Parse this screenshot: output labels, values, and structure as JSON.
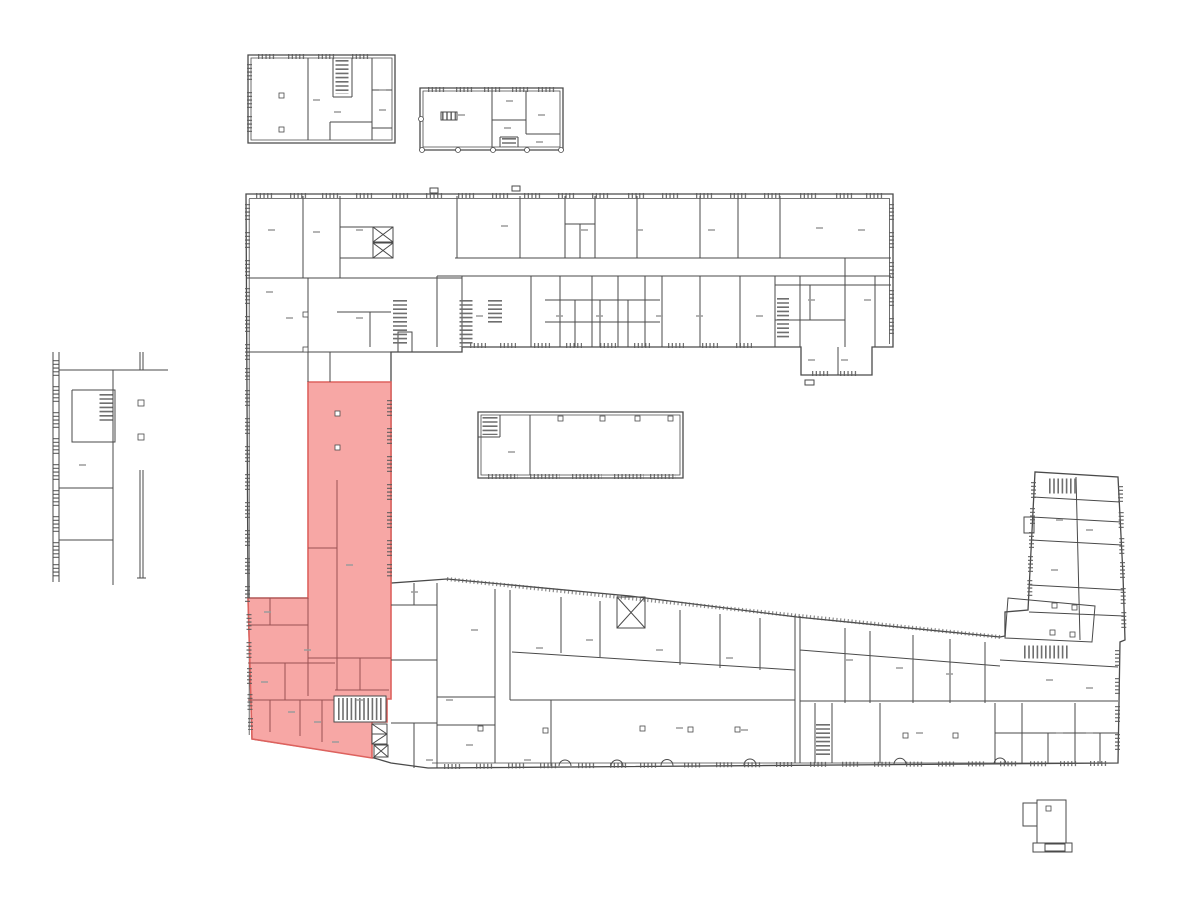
{
  "colors": {
    "bg": "#ffffff",
    "walls": "#4a4a4a",
    "windows": "#5a5a5a",
    "stairs": "#6f6f6f",
    "labels": "#9b9b9b",
    "hl-fill": "#f7a7a5",
    "hl-border": "#dd625e",
    "hl-walls": "#9a5252"
  },
  "highlight": {
    "points": "308,382 391,382 391,699 387,699 387,722 372,722 372,758 252,739 248,598 308,598",
    "stair_cutout": {
      "x": 334,
      "y": 696,
      "w": 52,
      "h": 26
    }
  }
}
